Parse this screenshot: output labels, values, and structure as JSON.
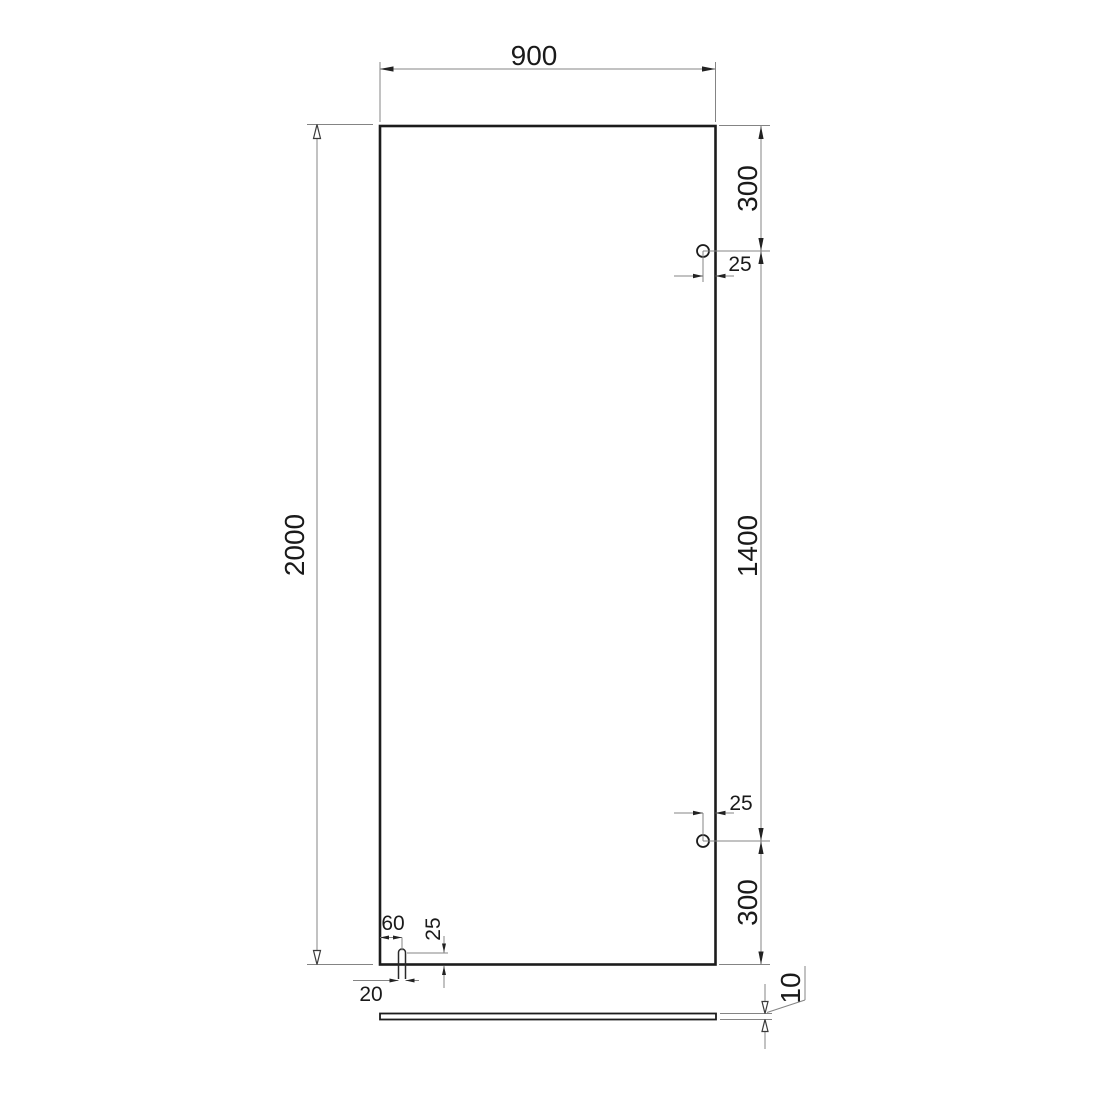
{
  "page": {
    "background": "#ffffff"
  },
  "style": {
    "outline_color": "#1c1c1c",
    "thin_line_color": "#848484",
    "text_color": "#1a1a1a"
  },
  "drawing": {
    "labels": {
      "panel_width": "900",
      "panel_height": "2000",
      "top_hole_from_top": "300",
      "top_hole_from_edge": "25",
      "hole_to_hole": "1400",
      "bottom_hole_from_edge": "25",
      "bottom_hole_from_bottom": "300",
      "slot_center_from_left": "60",
      "slot_depth": "25",
      "slot_width": "20",
      "glass_thickness": "10"
    }
  }
}
